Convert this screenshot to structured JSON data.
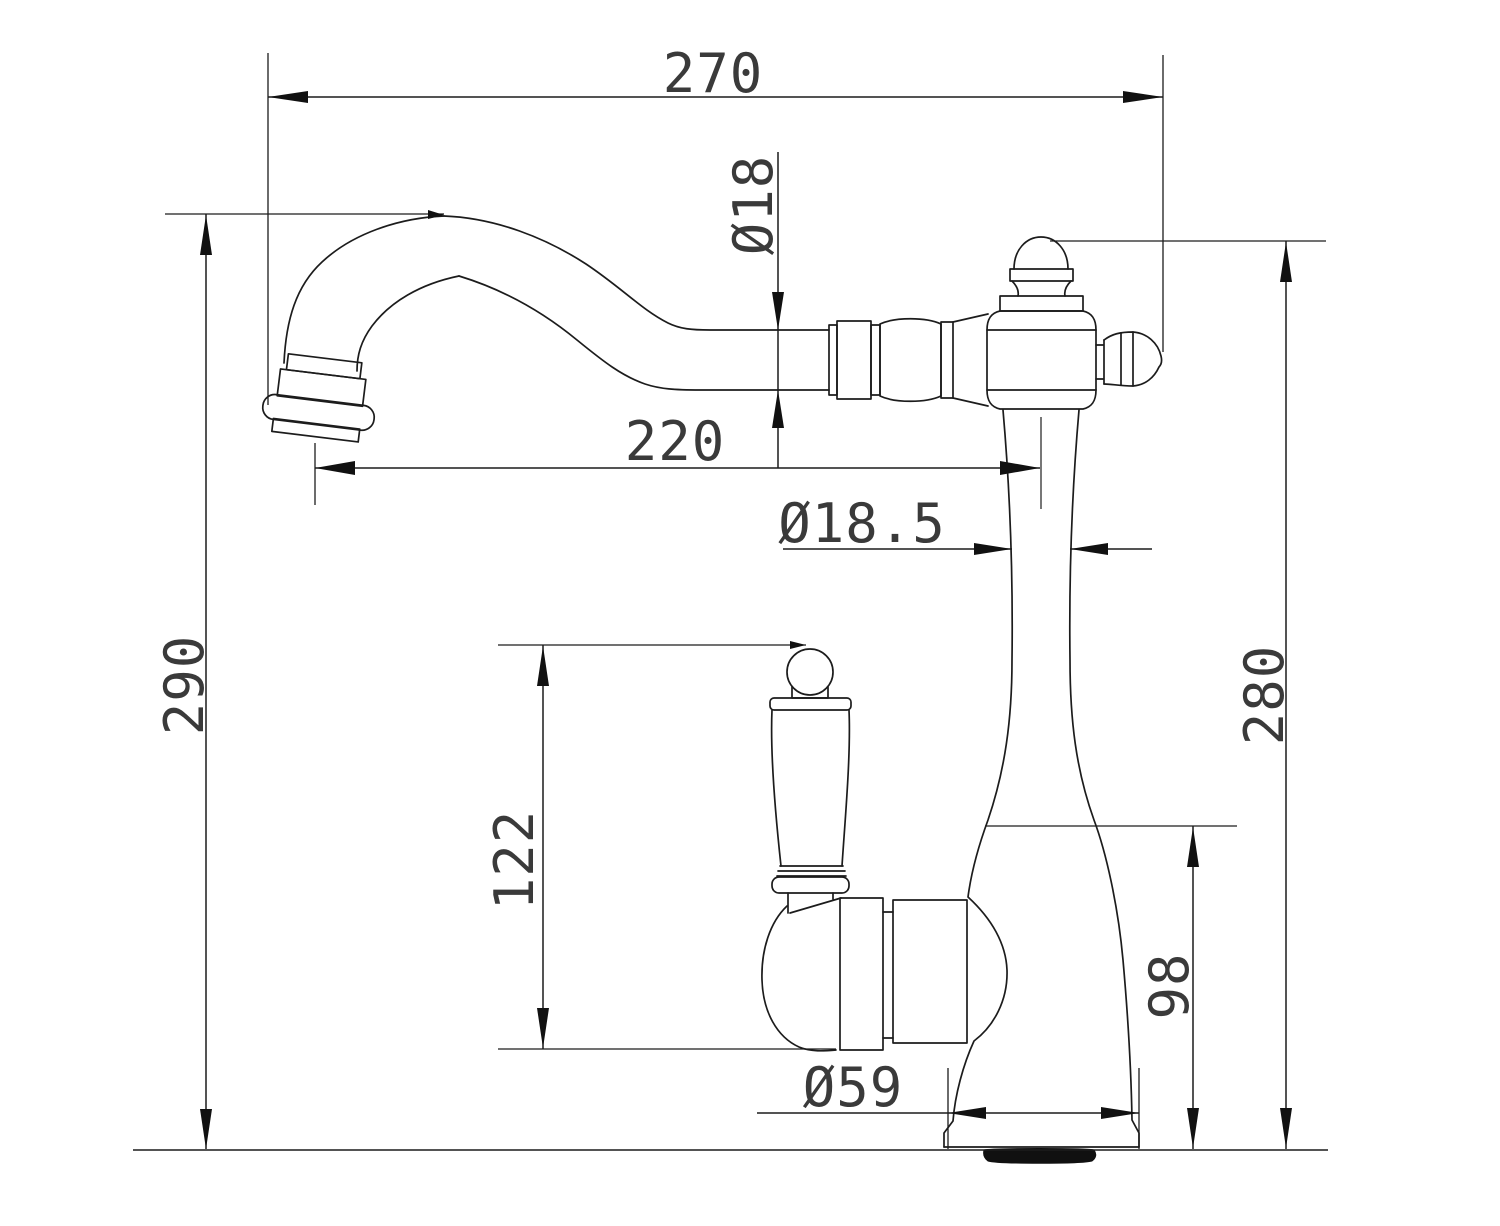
{
  "drawing": {
    "kind": "technical-dimension-drawing",
    "subject": "single-handle swan-neck faucet elevation",
    "background_color": "#ffffff",
    "line_color": "#1c1c1c",
    "text_color": "#3a3a3a",
    "dims": {
      "d270": {
        "label": "270",
        "orientation": "horizontal"
      },
      "d18": {
        "label": "Ø18",
        "orientation": "vertical-rotated"
      },
      "d220": {
        "label": "220",
        "orientation": "horizontal"
      },
      "d18_5": {
        "label": "Ø18.5",
        "orientation": "horizontal"
      },
      "d290": {
        "label": "290",
        "orientation": "vertical-rotated"
      },
      "d122": {
        "label": "122",
        "orientation": "vertical-rotated"
      },
      "d280": {
        "label": "280",
        "orientation": "vertical-rotated"
      },
      "d98": {
        "label": "98",
        "orientation": "vertical-rotated"
      },
      "d59": {
        "label": "Ø59",
        "orientation": "horizontal"
      }
    }
  }
}
